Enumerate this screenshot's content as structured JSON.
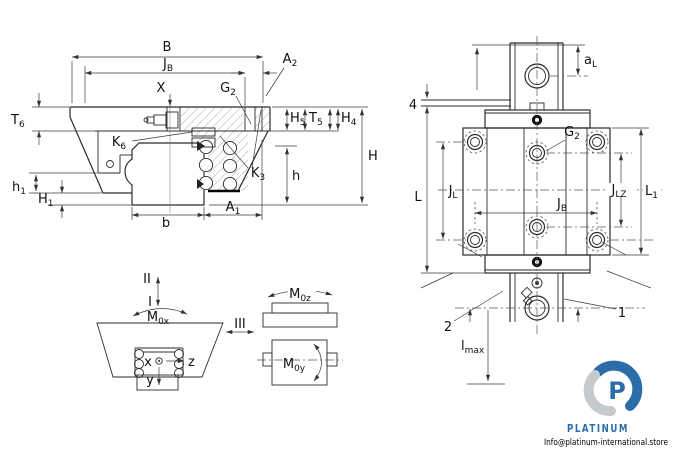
{
  "colors": {
    "line": "#2b2b2b",
    "logo_blue": "#2a6da8",
    "logo_gray": "#c5cacd"
  },
  "fig1": {
    "B": {
      "t": "B"
    },
    "JB": {
      "t": "J",
      "s": "B"
    },
    "A2": {
      "t": "A",
      "s": "2"
    },
    "X": {
      "t": "X"
    },
    "G2": {
      "t": "G",
      "s": "2"
    },
    "T6": {
      "t": "T",
      "s": "6"
    },
    "K6": {
      "t": "K",
      "s": "6"
    },
    "H5": {
      "t": "H",
      "s": "5"
    },
    "T5": {
      "t": "T",
      "s": "5"
    },
    "H4": {
      "t": "H",
      "s": "4"
    },
    "H": {
      "t": "H"
    },
    "K3": {
      "t": "K",
      "s": "3"
    },
    "h": {
      "t": "h"
    },
    "h1": {
      "t": "h",
      "s": "1"
    },
    "H1": {
      "t": "H",
      "s": "1"
    },
    "b": {
      "t": "b"
    },
    "A1": {
      "t": "A",
      "s": "1"
    }
  },
  "fig2": {
    "aL": {
      "t": "a",
      "s": "L"
    },
    "n4": {
      "t": "4"
    },
    "G2": {
      "t": "G",
      "s": "2"
    },
    "L": {
      "t": "L"
    },
    "JL": {
      "t": "J",
      "s": "L"
    },
    "JB": {
      "t": "J",
      "s": "B"
    },
    "JLZ": {
      "t": "J",
      "s": "LZ"
    },
    "L1": {
      "t": "L",
      "s": "1"
    },
    "n2": {
      "t": "2"
    },
    "n1": {
      "t": "1"
    },
    "lmax": {
      "t": "l",
      "s": "max"
    }
  },
  "fig3": {
    "I": {
      "t": "I"
    },
    "II": {
      "t": "II"
    },
    "III": {
      "t": "III"
    },
    "M0x": {
      "t": "M",
      "s": "0x"
    },
    "M0z": {
      "t": "M",
      "s": "0z"
    },
    "M0y": {
      "t": "M",
      "s": "0y"
    },
    "x": {
      "t": "x"
    },
    "y": {
      "t": "y"
    },
    "z": {
      "t": "z"
    }
  },
  "logo": {
    "brand": "PLATINUM",
    "email": "Info@platinum-international.store",
    "letter": "P"
  }
}
